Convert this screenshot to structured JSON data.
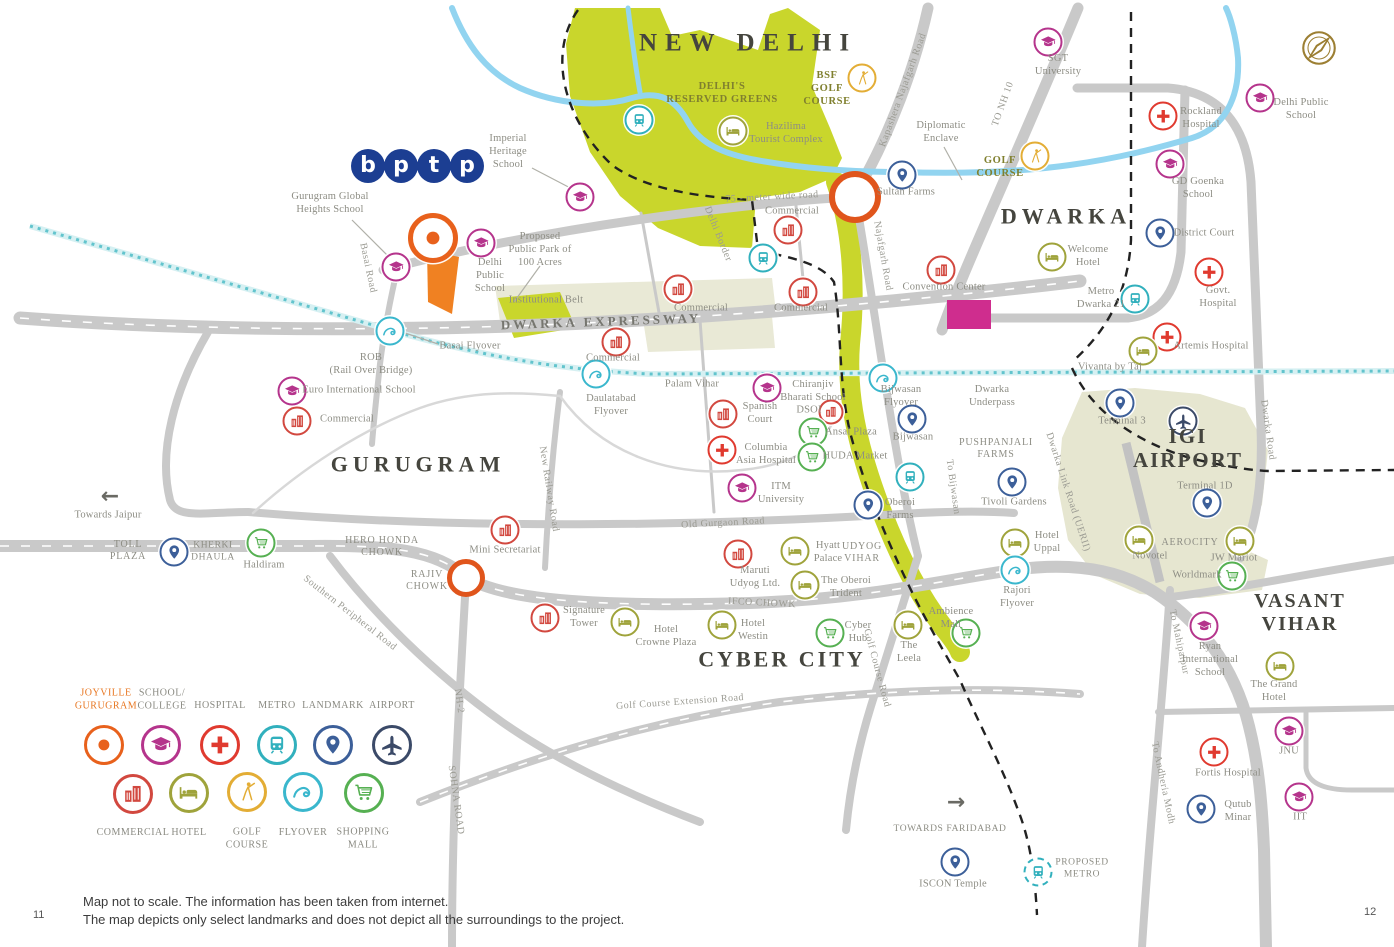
{
  "footer": {
    "line1": "Map not to scale. The information has been taken from internet.",
    "line2": "The map depicts only select landmarks and does not depict all the surroundings to the project.",
    "page_left": "11",
    "page_right": "12"
  },
  "logo": {
    "letters": [
      "b",
      "p",
      "t",
      "p"
    ],
    "color": "#1c3e92"
  },
  "icon_colors": {
    "joyville": "#e8611c",
    "school": "#b5348c",
    "hospital": "#e03a2f",
    "metro": "#31b0bd",
    "landmark": "#3c5f99",
    "airport": "#3b4a68",
    "commercial": "#d2483f",
    "hotel": "#9fa33b",
    "golf": "#e3ad35",
    "flyover": "#3ab7cd",
    "mall": "#56b052"
  },
  "regions": [
    {
      "label": "NEW DELHI",
      "x": 748,
      "y": 44,
      "size": 25,
      "ls": 8
    },
    {
      "label": "DWARKA",
      "x": 1066,
      "y": 216,
      "size": 22,
      "ls": 5
    },
    {
      "label": "GURUGRAM",
      "x": 418,
      "y": 464,
      "size": 22,
      "ls": 5
    },
    {
      "label": "CYBER CITY",
      "x": 782,
      "y": 659,
      "size": 22,
      "ls": 3
    },
    {
      "label": "VASANT\nVIHAR",
      "x": 1300,
      "y": 613,
      "size": 20,
      "ls": 2
    },
    {
      "label": "IGI\nAIRPORT",
      "x": 1188,
      "y": 448,
      "size": 21,
      "ls": 2
    }
  ],
  "areas": [
    {
      "label": "DELHI'S\nRESERVED GREENS",
      "x": 722,
      "y": 94,
      "cls": "olive"
    },
    {
      "label": "BSF\nGOLF\nCOURSE",
      "x": 827,
      "y": 89,
      "cls": "olive"
    },
    {
      "label": "GOLF\nCOURSE",
      "x": 1000,
      "y": 168,
      "cls": "olive"
    },
    {
      "label": "Diplomatic\nEnclave",
      "x": 941,
      "y": 133
    },
    {
      "label": "Institutional Belt",
      "x": 546,
      "y": 301
    },
    {
      "label": "UDYOG\nVIHAR",
      "x": 862,
      "y": 553,
      "cls": "capsarea"
    },
    {
      "label": "PUSHPANJALI\nFARMS",
      "x": 996,
      "y": 449,
      "cls": "capsarea"
    },
    {
      "label": "AEROCITY",
      "x": 1190,
      "y": 543,
      "cls": "capsarea"
    },
    {
      "label": "HERO HONDA\nCHOWK",
      "x": 382,
      "y": 547,
      "cls": "capsarea"
    },
    {
      "label": "RAJIV\nCHOWK",
      "x": 427,
      "y": 581,
      "cls": "capsarea"
    },
    {
      "label": "TOLL\nPLAZA",
      "x": 128,
      "y": 551,
      "cls": "capsarea"
    },
    {
      "label": "ROB\n(Rail Over Bridge)",
      "x": 371,
      "y": 365
    },
    {
      "label": "Basai Flyover",
      "x": 470,
      "y": 347
    },
    {
      "label": "Palam Vihar",
      "x": 692,
      "y": 385
    },
    {
      "label": "Daulatabad\nFlyover",
      "x": 611,
      "y": 406
    },
    {
      "label": "Dwarka\nUnderpass",
      "x": 992,
      "y": 397
    },
    {
      "label": "Proposed\nPublic Park of\n100 Acres",
      "x": 540,
      "y": 250
    },
    {
      "label": "Bijwasan\nFlyover",
      "x": 901,
      "y": 397
    },
    {
      "label": "Rajori\nFlyover",
      "x": 1017,
      "y": 598
    }
  ],
  "road_labels": [
    {
      "label": "Kapashera Najafgarh Road",
      "x": 903,
      "y": 90,
      "rot": -70
    },
    {
      "label": "TO NH 10",
      "x": 1003,
      "y": 104,
      "rot": -70
    },
    {
      "label": "DWARKA EXPRESSWAY",
      "x": 601,
      "y": 322,
      "rot": -2,
      "cls": "expwy"
    },
    {
      "label": "75 - meter wide road",
      "x": 772,
      "y": 197,
      "rot": -3
    },
    {
      "label": "Basai Road",
      "x": 368,
      "y": 268,
      "rot": 78
    },
    {
      "label": "Delhi Border",
      "x": 718,
      "y": 234,
      "rot": 68
    },
    {
      "label": "Najafgarh Road",
      "x": 883,
      "y": 256,
      "rot": 80
    },
    {
      "label": "New Railway Road",
      "x": 549,
      "y": 489,
      "rot": 81
    },
    {
      "label": "Old Gurgaon Road",
      "x": 723,
      "y": 523,
      "rot": -3
    },
    {
      "label": "Southern Peripheral Road",
      "x": 350,
      "y": 613,
      "rot": 38
    },
    {
      "label": "IFCO CHOWK",
      "x": 762,
      "y": 603,
      "rot": 3
    },
    {
      "label": "Golf Course Road",
      "x": 877,
      "y": 668,
      "rot": 75
    },
    {
      "label": "Golf Course Extension Road",
      "x": 680,
      "y": 702,
      "rot": -4
    },
    {
      "label": "NH-2",
      "x": 459,
      "y": 701,
      "rot": 82
    },
    {
      "label": "SOHNA ROAD",
      "x": 456,
      "y": 800,
      "rot": 82
    },
    {
      "label": "To Bijwasan",
      "x": 953,
      "y": 487,
      "rot": 82
    },
    {
      "label": "Dwarka Link Road (UERII)",
      "x": 1068,
      "y": 492,
      "rot": 72
    },
    {
      "label": "Dwarka Road",
      "x": 1268,
      "y": 430,
      "rot": 82
    },
    {
      "label": "To Mahipalpur",
      "x": 1179,
      "y": 642,
      "rot": 78
    },
    {
      "label": "To Andheria Modh",
      "x": 1163,
      "y": 783,
      "rot": 78
    }
  ],
  "places": [
    {
      "icon": "joyville",
      "x": 433,
      "y": 238,
      "size": 40,
      "big": true
    },
    {
      "icon": "school",
      "x": 1048,
      "y": 42,
      "label": "SGT\nUniversity",
      "lx": 1058,
      "ly": 66
    },
    {
      "icon": "school",
      "x": 1260,
      "y": 98,
      "label": "Delhi Public\nSchool",
      "lx": 1301,
      "ly": 110
    },
    {
      "icon": "hospital",
      "x": 1163,
      "y": 116,
      "label": "Rockland\nHospital",
      "lx": 1201,
      "ly": 119
    },
    {
      "icon": "school",
      "x": 1170,
      "y": 164,
      "label": "GD Goenka\nSchool",
      "lx": 1198,
      "ly": 189
    },
    {
      "icon": "landmark",
      "x": 1160,
      "y": 233,
      "label": "District Court",
      "lx": 1204,
      "ly": 234
    },
    {
      "icon": "hotel",
      "x": 1052,
      "y": 257,
      "label": "Welcome\nHotel",
      "lx": 1088,
      "ly": 257
    },
    {
      "icon": "hospital",
      "x": 1209,
      "y": 272,
      "label": "Govt.\nHospital",
      "lx": 1218,
      "ly": 298
    },
    {
      "icon": "metro",
      "x": 1135,
      "y": 299,
      "label": "Metro\nDwarka 21",
      "lx": 1101,
      "ly": 299
    },
    {
      "icon": "hospital",
      "x": 1167,
      "y": 337,
      "label": "Artemis Hospital",
      "lx": 1211,
      "ly": 347
    },
    {
      "icon": "hotel",
      "x": 1143,
      "y": 351,
      "label": "Vivanta by Taj",
      "lx": 1110,
      "ly": 368
    },
    {
      "icon": "golf",
      "x": 862,
      "y": 78
    },
    {
      "icon": "golf",
      "x": 1035,
      "y": 156
    },
    {
      "icon": "hotel",
      "x": 733,
      "y": 131,
      "label": "Hazilima\nTourist Complex",
      "lx": 786,
      "ly": 134
    },
    {
      "icon": "landmark",
      "x": 902,
      "y": 175,
      "label": "Sultan Farms",
      "lx": 906,
      "ly": 193
    },
    {
      "icon": "metro",
      "x": 639,
      "y": 120
    },
    {
      "icon": "metro",
      "x": 763,
      "y": 258
    },
    {
      "icon": "commercial",
      "x": 788,
      "y": 230,
      "label": "Commercial",
      "lx": 792,
      "ly": 212
    },
    {
      "icon": "commercial",
      "x": 678,
      "y": 289,
      "label": "Commercial",
      "lx": 701,
      "ly": 309
    },
    {
      "icon": "commercial",
      "x": 803,
      "y": 292,
      "label": "Commercial",
      "lx": 801,
      "ly": 309
    },
    {
      "icon": "commercial",
      "x": 616,
      "y": 342,
      "label": "Commercial",
      "lx": 613,
      "ly": 359
    },
    {
      "icon": "commercial",
      "x": 297,
      "y": 421,
      "label": "Commercial",
      "lx": 347,
      "ly": 420
    },
    {
      "icon": "commercial",
      "x": 941,
      "y": 270,
      "label": "Convention Center",
      "lx": 944,
      "ly": 288
    },
    {
      "icon": "school",
      "x": 580,
      "y": 197,
      "label": "Imperial\nHeritage\nSchool",
      "lx": 508,
      "ly": 152
    },
    {
      "icon": "school",
      "x": 396,
      "y": 267,
      "label": "Gurugram Global\nHeights School",
      "lx": 330,
      "ly": 204
    },
    {
      "icon": "school",
      "x": 481,
      "y": 243,
      "label": "Delhi\nPublic\nSchool",
      "lx": 490,
      "ly": 276
    },
    {
      "icon": "school",
      "x": 292,
      "y": 391,
      "label": "Euro International School",
      "lx": 359,
      "ly": 391
    },
    {
      "icon": "school",
      "x": 767,
      "y": 388,
      "label": "Chiranjiv\nBharati School",
      "lx": 813,
      "ly": 392
    },
    {
      "icon": "commercial",
      "x": 831,
      "y": 412,
      "label": "DSOI",
      "lx": 809,
      "ly": 411,
      "size": 21
    },
    {
      "icon": "commercial",
      "x": 723,
      "y": 414,
      "label": "Spanish\nCourt",
      "lx": 760,
      "ly": 414
    },
    {
      "icon": "hospital",
      "x": 722,
      "y": 450,
      "label": "Columbia\nAsia Hospital",
      "lx": 766,
      "ly": 455
    },
    {
      "icon": "school",
      "x": 742,
      "y": 488,
      "label": "ITM\nUniversity",
      "lx": 781,
      "ly": 494
    },
    {
      "icon": "mall",
      "x": 813,
      "y": 432,
      "label": "Ansal Plaza",
      "lx": 851,
      "ly": 433
    },
    {
      "icon": "mall",
      "x": 812,
      "y": 457,
      "label": "HUDA Market",
      "lx": 855,
      "ly": 457
    },
    {
      "icon": "flyover",
      "x": 390,
      "y": 331
    },
    {
      "icon": "flyover",
      "x": 596,
      "y": 374
    },
    {
      "icon": "flyover",
      "x": 883,
      "y": 378
    },
    {
      "icon": "metro",
      "x": 910,
      "y": 477
    },
    {
      "icon": "landmark",
      "x": 912,
      "y": 419,
      "label": "Bijwasan",
      "lx": 913,
      "ly": 438
    },
    {
      "icon": "landmark",
      "x": 868,
      "y": 505,
      "label": "Oberoi\nFarms",
      "lx": 900,
      "ly": 510
    },
    {
      "icon": "landmark",
      "x": 1012,
      "y": 482,
      "label": "Tivoli Gardens",
      "lx": 1014,
      "ly": 503
    },
    {
      "icon": "landmark",
      "x": 1120,
      "y": 403,
      "label": "Terminal 3",
      "lx": 1122,
      "ly": 422
    },
    {
      "icon": "airport",
      "x": 1183,
      "y": 421
    },
    {
      "icon": "landmark",
      "x": 1207,
      "y": 503,
      "label": "Terminal 1D",
      "lx": 1205,
      "ly": 487
    },
    {
      "ic": 0,
      "icon": "hotel",
      "x": 1139,
      "y": 540,
      "label": "Novotel",
      "lx": 1150,
      "ly": 557
    },
    {
      "icon": "hotel",
      "x": 1240,
      "y": 541,
      "label": "JW Mariot",
      "lx": 1234,
      "ly": 559
    },
    {
      "icon": "mall",
      "x": 1232,
      "y": 576,
      "label": "Worldmark",
      "lx": 1197,
      "ly": 576
    },
    {
      "icon": "mall",
      "x": 261,
      "y": 543,
      "label": "Haldiram",
      "lx": 264,
      "ly": 566
    },
    {
      "icon": "landmark",
      "x": 174,
      "y": 552,
      "label": "KHERKI\nDHAULA",
      "lx": 213,
      "ly": 552,
      "caps": true
    },
    {
      "icon": "commercial",
      "x": 505,
      "y": 530,
      "label": "Mini Secretariat",
      "lx": 505,
      "ly": 551
    },
    {
      "icon": "commercial",
      "x": 738,
      "y": 554,
      "label": "Maruti\nUdyog Ltd.",
      "lx": 755,
      "ly": 578
    },
    {
      "icon": "hotel",
      "x": 795,
      "y": 551,
      "label": "Hyatt\nPalace",
      "lx": 828,
      "ly": 553
    },
    {
      "icon": "hotel",
      "x": 805,
      "y": 585,
      "label": "The Oberoi\nTrident",
      "lx": 846,
      "ly": 588
    },
    {
      "icon": "hotel",
      "x": 1015,
      "y": 543,
      "label": "Hotel\nUppal",
      "lx": 1047,
      "ly": 543
    },
    {
      "icon": "commercial",
      "x": 545,
      "y": 618,
      "label": "Signature\nTower",
      "lx": 584,
      "ly": 618
    },
    {
      "icon": "hotel",
      "x": 625,
      "y": 622,
      "label": "Hotel\nCrowne Plaza",
      "lx": 666,
      "ly": 637
    },
    {
      "icon": "hotel",
      "x": 722,
      "y": 625,
      "label": "Hotel\nWestin",
      "lx": 753,
      "ly": 631
    },
    {
      "icon": "mall",
      "x": 830,
      "y": 633,
      "label": "Cyber\nHub",
      "lx": 858,
      "ly": 633
    },
    {
      "icon": "hotel",
      "x": 908,
      "y": 625,
      "label": "The\nLeela",
      "lx": 909,
      "ly": 653
    },
    {
      "icon": "mall",
      "x": 966,
      "y": 633,
      "label": "Ambience\nMall",
      "lx": 951,
      "ly": 619
    },
    {
      "icon": "flyover",
      "x": 1015,
      "y": 570
    },
    {
      "icon": "school",
      "x": 1204,
      "y": 626,
      "label": "Ryan\nInternational\nSchool",
      "lx": 1210,
      "ly": 660
    },
    {
      "icon": "hotel",
      "x": 1280,
      "y": 666,
      "label": "The Grand\nHotel",
      "lx": 1274,
      "ly": 692
    },
    {
      "icon": "school",
      "x": 1289,
      "y": 731,
      "label": "JNU",
      "lx": 1289,
      "ly": 752
    },
    {
      "icon": "hospital",
      "x": 1214,
      "y": 752,
      "label": "Fortis Hospital",
      "lx": 1228,
      "ly": 774
    },
    {
      "icon": "landmark",
      "x": 1201,
      "y": 809,
      "label": "Qutub\nMinar",
      "lx": 1238,
      "ly": 812
    },
    {
      "icon": "school",
      "x": 1299,
      "y": 797,
      "label": "IIT",
      "lx": 1300,
      "ly": 818
    },
    {
      "icon": "landmark",
      "x": 955,
      "y": 862,
      "label": "ISCON Temple",
      "lx": 953,
      "ly": 885
    },
    {
      "icon": "metro",
      "x": 1038,
      "y": 872,
      "label": "PROPOSED\nMETRO",
      "lx": 1082,
      "ly": 869,
      "caps": true,
      "dashed": true
    }
  ],
  "arrows": [
    {
      "glyph": "←",
      "x": 110,
      "y": 497,
      "label": "Towards Jaipur",
      "lx": 108,
      "ly": 516
    },
    {
      "glyph": "→",
      "x": 956,
      "y": 803,
      "label": "TOWARDS FARIDABAD",
      "lx": 950,
      "ly": 830,
      "caps": true
    }
  ],
  "junctions": [
    {
      "x": 855,
      "y": 197,
      "r": 20,
      "w": 6,
      "color": "#e0551c"
    },
    {
      "x": 466,
      "y": 578,
      "r": 14,
      "w": 5,
      "color": "#e0551c"
    }
  ],
  "legend": {
    "row1": [
      {
        "icon": "joyville",
        "label": "JOYVILLE\nGURUGRAM",
        "x": 104,
        "y": 745,
        "lx": 106,
        "ly": 700,
        "accent": true,
        "big": true
      },
      {
        "icon": "school",
        "label": "SCHOOL/\nCOLLEGE",
        "x": 161,
        "y": 745,
        "lx": 162,
        "ly": 700
      },
      {
        "icon": "hospital",
        "label": "HOSPITAL",
        "x": 220,
        "y": 745,
        "lx": 220,
        "ly": 706
      },
      {
        "icon": "metro",
        "label": "METRO",
        "x": 277,
        "y": 745,
        "lx": 277,
        "ly": 706
      },
      {
        "icon": "landmark",
        "label": "LANDMARK",
        "x": 333,
        "y": 745,
        "lx": 333,
        "ly": 706
      },
      {
        "icon": "airport",
        "label": "AIRPORT",
        "x": 392,
        "y": 745,
        "lx": 392,
        "ly": 706
      }
    ],
    "row2": [
      {
        "icon": "commercial",
        "label": "COMMERCIAL",
        "x": 133,
        "y": 794,
        "lx": 133,
        "ly": 833
      },
      {
        "icon": "hotel",
        "label": "HOTEL",
        "x": 189,
        "y": 793,
        "lx": 189,
        "ly": 833
      },
      {
        "icon": "golf",
        "label": "GOLF\nCOURSE",
        "x": 247,
        "y": 792,
        "lx": 247,
        "ly": 839
      },
      {
        "icon": "flyover",
        "label": "FLYOVER",
        "x": 303,
        "y": 792,
        "lx": 303,
        "ly": 833
      },
      {
        "icon": "mall",
        "label": "SHOPPING\nMALL",
        "x": 364,
        "y": 793,
        "lx": 363,
        "ly": 839
      }
    ]
  }
}
